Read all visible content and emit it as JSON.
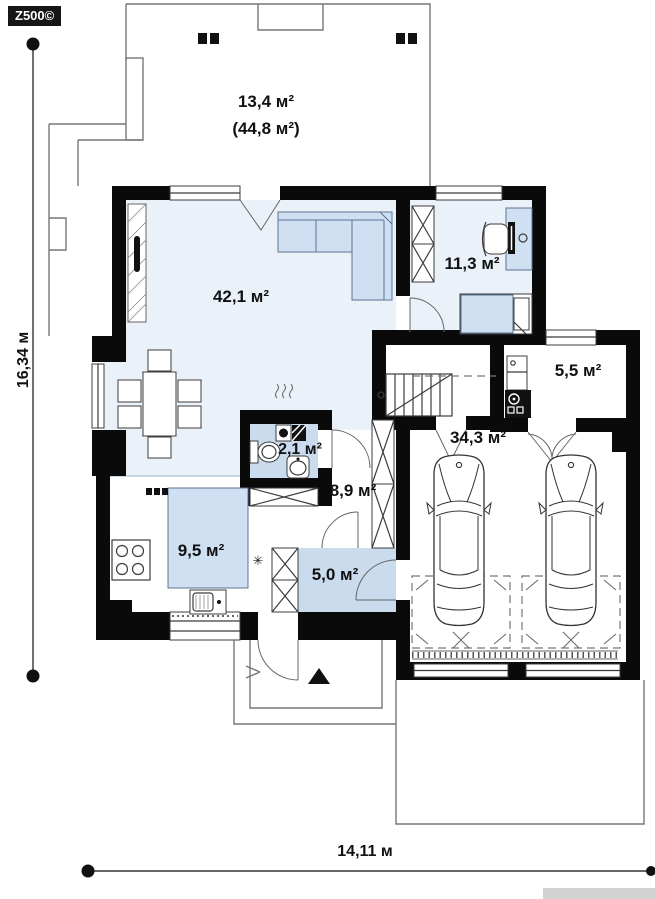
{
  "logo": "Z500©",
  "dimensions": {
    "height_label": "16,34 м",
    "width_label": "14,11 м"
  },
  "rooms": {
    "terrace": {
      "name": "terrace",
      "area": "13,4 м²",
      "total_area": "(44,8 м²)"
    },
    "living_room": {
      "name": "living-room",
      "area": "42,1 м²"
    },
    "bedroom": {
      "name": "bedroom",
      "area": "11,3 м²"
    },
    "boiler_room": {
      "name": "boiler-room",
      "area": "5,5 м²"
    },
    "garage": {
      "name": "garage",
      "area": "34,3 м²"
    },
    "bathroom": {
      "name": "bathroom",
      "area": "2,1 м²"
    },
    "hall": {
      "name": "hall",
      "area": "8,9 м²"
    },
    "kitchen": {
      "name": "kitchen",
      "area": "9,5 м²"
    },
    "vestibule": {
      "name": "vestibule",
      "area": "5,0 м²"
    }
  },
  "symbols": {
    "snowflake": "✳"
  },
  "colors": {
    "wall": "#0a0a0a",
    "floor_light": "#eaf1f8",
    "floor_blue": "#c9dbed",
    "furniture": "#cfe0f3",
    "furn_stroke": "#5d7292",
    "line": "#3c3c3c"
  }
}
